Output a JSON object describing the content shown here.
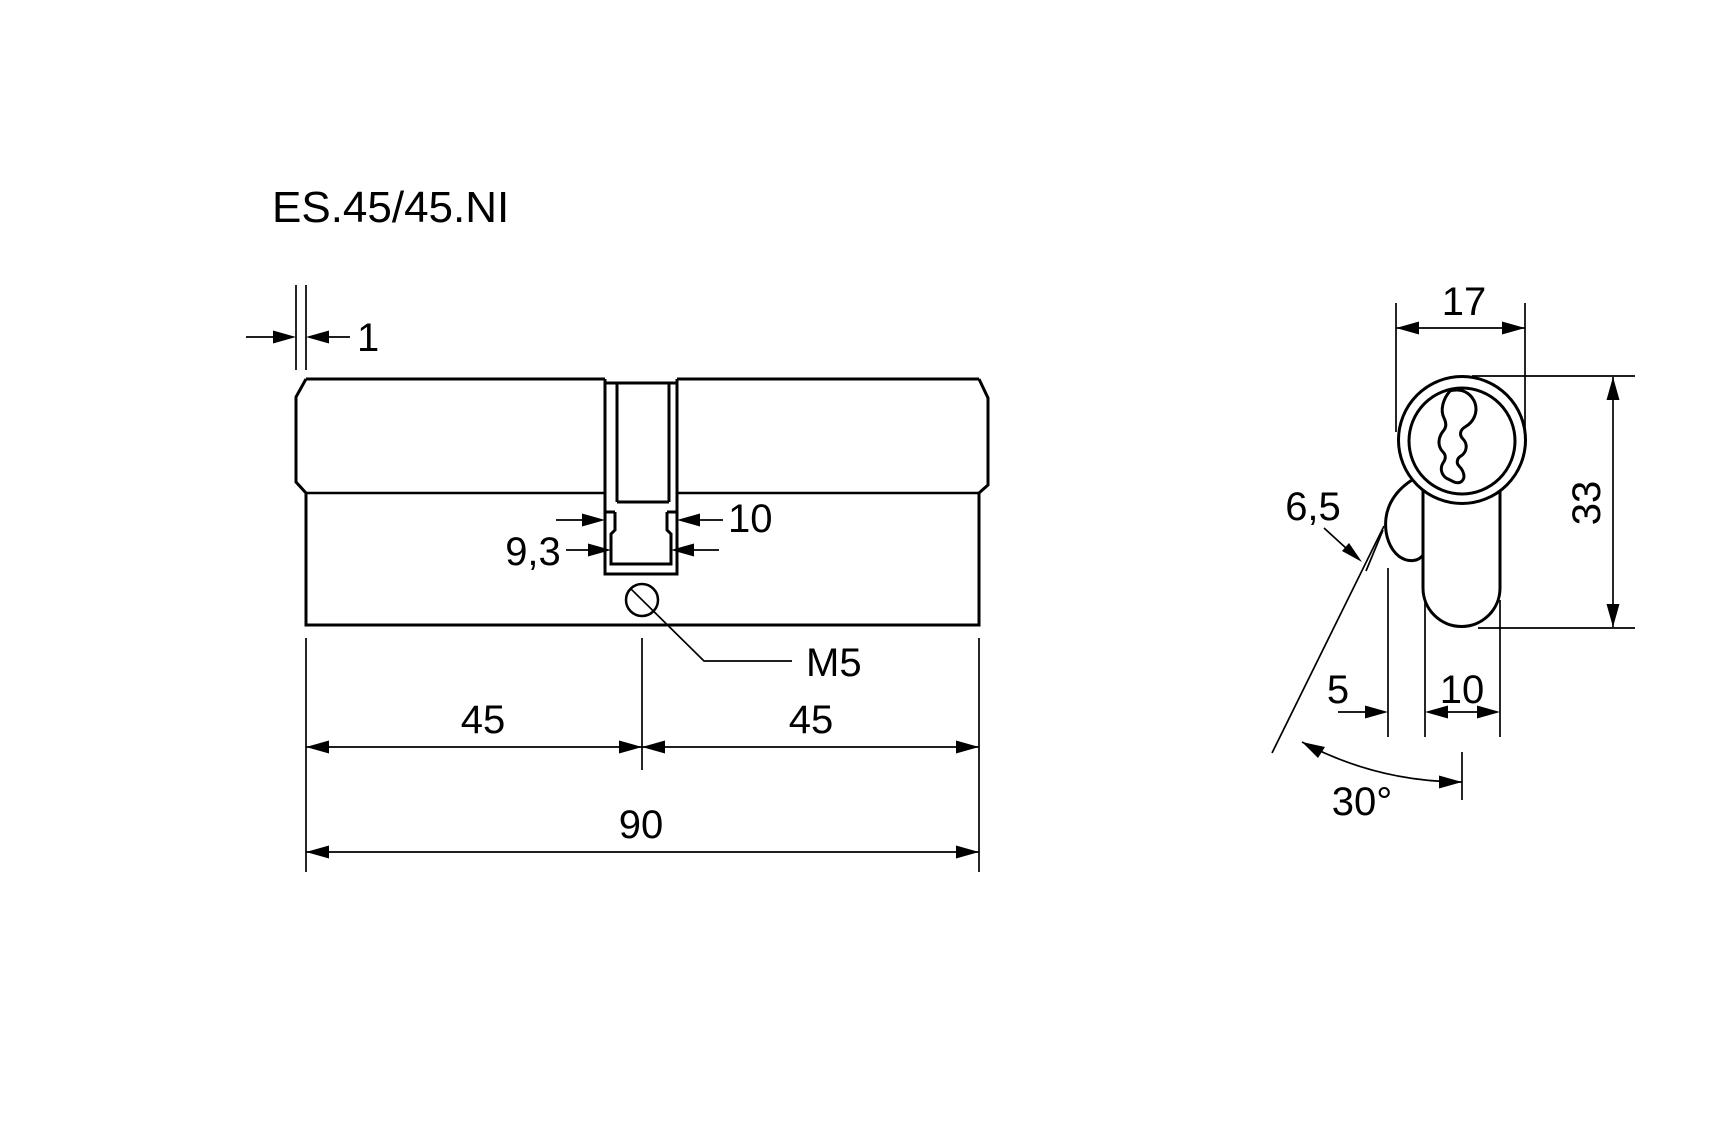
{
  "title": "ES.45/45.NI",
  "drawing": {
    "colors": {
      "line": "#000000",
      "background": "#ffffff"
    },
    "side_view": {
      "name": "double-cylinder side view",
      "dims": {
        "end_cap": "1",
        "cam_slot_width": "10",
        "cam_lower_width": "9,3",
        "screw": "M5",
        "left_half": "45",
        "right_half": "45",
        "total": "90"
      }
    },
    "front_view": {
      "name": "euro-profile end view",
      "dims": {
        "width": "17",
        "height": "33",
        "cam_tip": "6,5",
        "cam_offset": "5",
        "blade_width": "10",
        "angle": "30°"
      }
    }
  }
}
